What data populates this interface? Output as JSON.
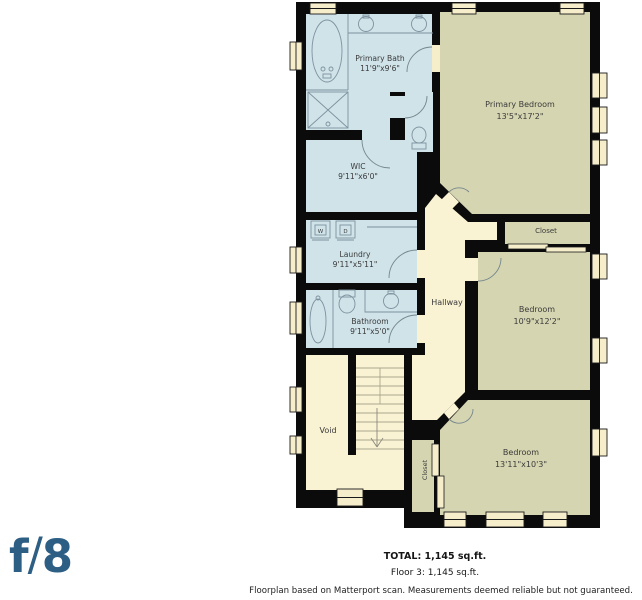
{
  "floorplan": {
    "rooms": {
      "primary_bath": {
        "name": "Primary Bath",
        "dims": "11'9\"x9'6\""
      },
      "wic": {
        "name": "WIC",
        "dims": "9'11\"x6'0\""
      },
      "laundry": {
        "name": "Laundry",
        "dims": "9'11\"x5'11\""
      },
      "bathroom": {
        "name": "Bathroom",
        "dims": "9'11\"x5'0\""
      },
      "hallway": {
        "name": "Hallway"
      },
      "void": {
        "name": "Void"
      },
      "primary_bedroom": {
        "name": "Primary Bedroom",
        "dims": "13'5\"x17'2\""
      },
      "closet_upper": {
        "name": "Closet"
      },
      "bedroom_middle": {
        "name": "Bedroom",
        "dims": "10'9\"x12'2\""
      },
      "closet_lower": {
        "name": "Closet"
      },
      "bedroom_lower": {
        "name": "Bedroom",
        "dims": "13'11\"x10'3\""
      }
    },
    "appliances": {
      "washer": "W",
      "dryer": "D"
    },
    "colors": {
      "wall": "#0b0b0b",
      "wet_room_fill": "#cfe3e9",
      "bedroom_fill": "#d5d5b1",
      "hall_fill": "#faf3d3",
      "window_fill": "#f6eecb"
    }
  },
  "footer": {
    "total": "TOTAL: 1,145 sq.ft.",
    "floor": "Floor 3: 1,145 sq.ft.",
    "disclaimer": "Floorplan based on Matterport scan. Measurements deemed reliable but not guaranteed."
  },
  "logo": {
    "f": "f",
    "slash": "/",
    "eight": "8"
  }
}
